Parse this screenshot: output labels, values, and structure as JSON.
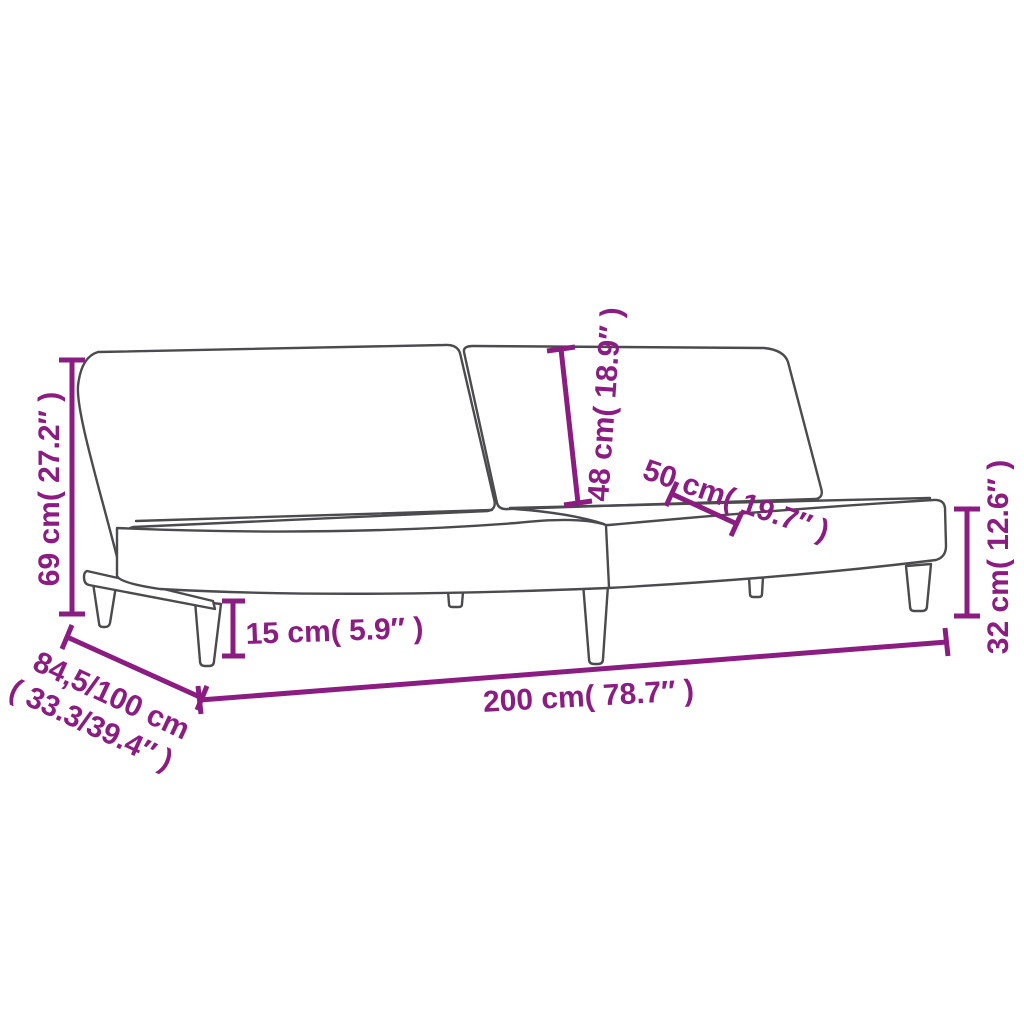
{
  "page": {
    "background": "#ffffff",
    "accent_color": "#8b1c81",
    "outline_color": "#4b4b4d"
  },
  "diagram": {
    "title": "sofa-bed dimension diagram",
    "labels": {
      "total_height": "69 cm( 27.2″ )",
      "depth_line1": "84,5/100 cm",
      "depth_line2": "( 33.3/39.4″ )",
      "leg_height": "15 cm( 5.9″ )",
      "backrest_height": "48 cm( 18.9″ )",
      "backrest_width": "50 cm( 19.7″ )",
      "seat_height": "32 cm( 12.6″ )",
      "total_width": "200 cm( 78.7″ )"
    }
  }
}
